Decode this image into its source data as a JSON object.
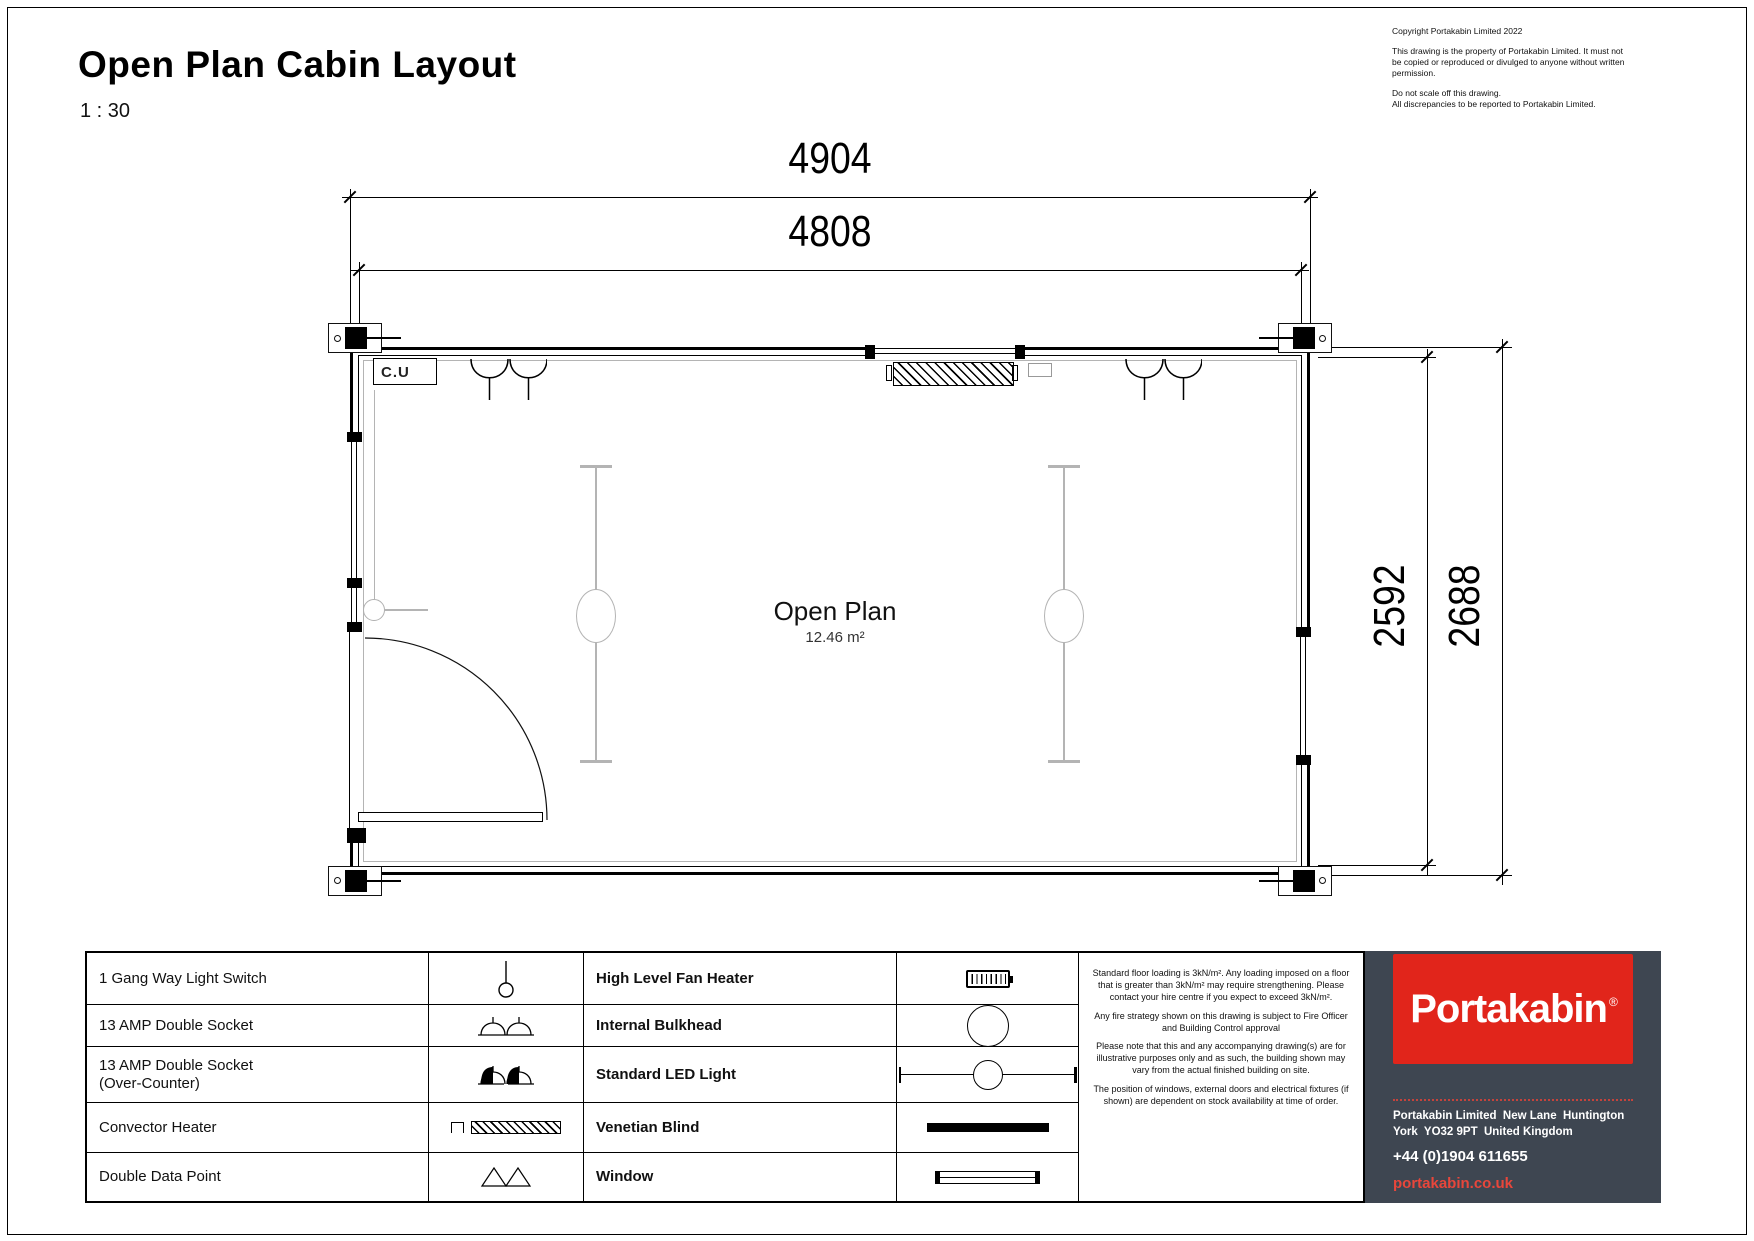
{
  "sheet": {
    "title": "Open Plan Cabin Layout",
    "scale": "1 : 30"
  },
  "copyright": {
    "line1": "Copyright Portakabin Limited 2022",
    "para1": "This drawing is the property of Portakabin Limited. It must not be copied or reproduced or divulged to anyone without written permission.",
    "para2": "Do not scale off this drawing.\nAll discrepancies to be reported to Portakabin Limited."
  },
  "plan": {
    "room_label": "Open Plan",
    "room_area": "12.46 m²",
    "cu_label": "C.U",
    "dim_overall_width": "4904",
    "dim_internal_width": "4808",
    "dim_internal_depth": "2592",
    "dim_overall_depth": "2688"
  },
  "legend": {
    "rows": [
      {
        "left": "1 Gang Way Light Switch",
        "right": "High Level Fan Heater"
      },
      {
        "left": "13 AMP Double Socket",
        "right": "Internal Bulkhead"
      },
      {
        "left": "13 AMP Double Socket",
        "left2": "(Over-Counter)",
        "right": "Standard LED Light"
      },
      {
        "left": "Convector Heater",
        "right": "Venetian Blind"
      },
      {
        "left": "Double Data Point",
        "right": "Window"
      }
    ]
  },
  "notes": {
    "p1": "Standard floor loading is 3kN/m². Any loading imposed on a floor that is greater than 3kN/m² may require strengthening. Please contact your hire centre if you expect to exceed 3kN/m².",
    "p2": "Any fire strategy shown on this drawing is subject to Fire Officer and Building Control approval",
    "p3": "Please note that this and any accompanying drawing(s) are for illustrative purposes only and as such, the building shown may vary from the actual finished building on site.",
    "p4": "The position of windows, external doors and electrical fixtures (if shown) are dependent on stock availability at time of order."
  },
  "footer": {
    "brand": "Portakabin",
    "registered": "®",
    "address1": "Portakabin Limited  New Lane  Huntington",
    "address2": "York  YO32 9PT  United Kingdom",
    "phone": "+44 (0)1904 611655",
    "website": "portakabin.co.uk",
    "colors": {
      "panel": "#3e4651",
      "brand_red": "#e1251b",
      "link_red": "#e8463b"
    }
  }
}
